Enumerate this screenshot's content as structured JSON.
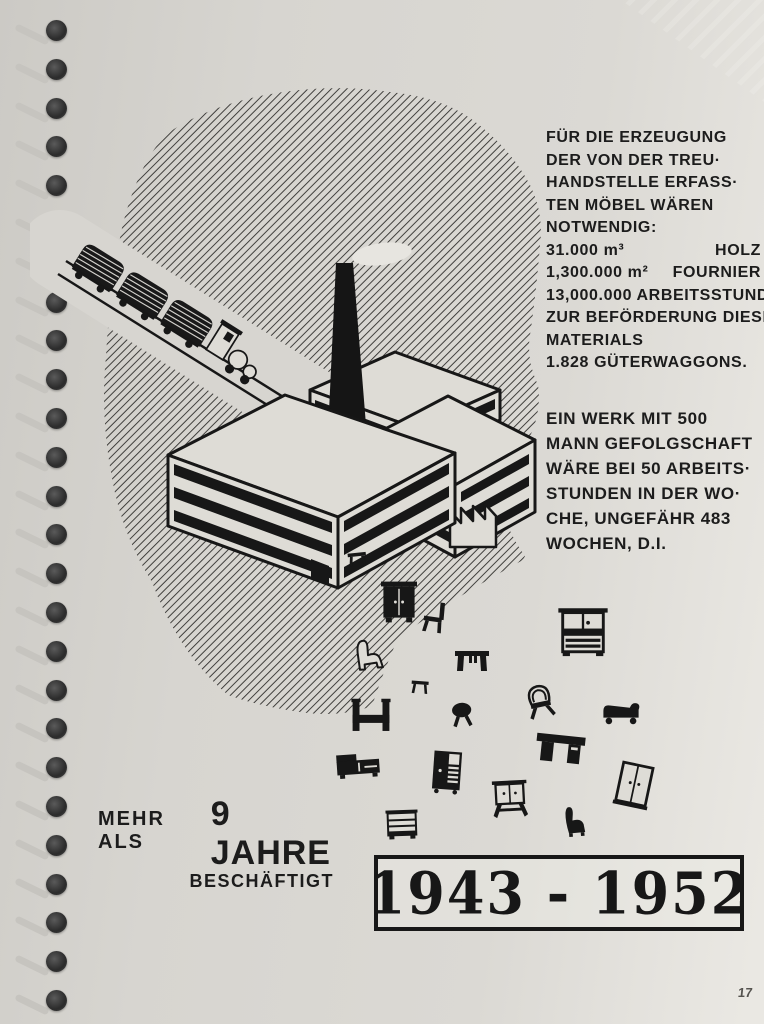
{
  "page": {
    "number": "17"
  },
  "materials_block": {
    "lines": [
      "FÜR DIE ERZEUGUNG",
      "DER VON DER TREU·",
      "HANDSTELLE ERFASS·",
      "TEN MÖBEL WÄREN",
      "NOTWENDIG:"
    ],
    "figures": [
      {
        "value": "31.000 m³",
        "label": "HOLZ"
      },
      {
        "value": "1,300.000 m²",
        "label": "FOURNIER"
      }
    ],
    "lines_after": [
      "13,000.000 ARBEITSSTUNDEN",
      "ZUR BEFÖRDERUNG DIESES",
      "MATERIALS",
      "1.828 GÜTERWAGGONS."
    ]
  },
  "work_block": {
    "lines": [
      "EIN WERK MIT 500",
      "MANN GEFOLGSCHAFT",
      "WÄRE BEI 50 ARBEITS·",
      "STUNDEN IN DER WO·",
      "CHE, UNGEFÄHR 483",
      "WOCHEN, D.I."
    ]
  },
  "caption": {
    "prefix": "MEHR ALS",
    "years": "9 JAHRE",
    "suffix": "BESCHÄFTIGT"
  },
  "year_box": {
    "range": "1943 - 1952"
  },
  "colors": {
    "paper": "#d9d7d2",
    "ink": "#171717",
    "hatch": "#2f2e2c"
  },
  "binding": {
    "holes": 26
  },
  "illustration": {
    "scene_parts": [
      "hatched-cloud-background",
      "rail-track",
      "freight-train-icon",
      "log-wagon-icon",
      "locomotive-icon",
      "smoke-puff-icon",
      "smokestack-icon",
      "factory-building-icon",
      "sawtooth-roof-icon"
    ],
    "furniture": [
      {
        "icon": "stool-icon",
        "type": "stool",
        "x": 357,
        "y": 557,
        "size": 28,
        "rot": -6
      },
      {
        "icon": "wardrobe-icon",
        "type": "wardrobe",
        "x": 399,
        "y": 602,
        "size": 48,
        "rot": 0
      },
      {
        "icon": "chair-icon",
        "type": "chair",
        "x": 434,
        "y": 617,
        "size": 36,
        "rot": 8
      },
      {
        "icon": "armchair-icon",
        "type": "armchair-outline",
        "x": 371,
        "y": 655,
        "size": 40,
        "rot": -4
      },
      {
        "icon": "table-icon",
        "type": "table",
        "x": 472,
        "y": 660,
        "size": 40,
        "rot": 0
      },
      {
        "icon": "stool-icon",
        "type": "stool",
        "x": 420,
        "y": 685,
        "size": 26,
        "rot": 4
      },
      {
        "icon": "dresser-icon",
        "type": "dresser",
        "x": 583,
        "y": 630,
        "size": 58,
        "rot": 0
      },
      {
        "icon": "wicker-chair-icon",
        "type": "wicker-chair",
        "x": 540,
        "y": 701,
        "size": 40,
        "rot": -12
      },
      {
        "icon": "bed-icon",
        "type": "bed",
        "x": 371,
        "y": 716,
        "size": 46,
        "rot": 0
      },
      {
        "icon": "round-stool-icon",
        "type": "round-stool",
        "x": 462,
        "y": 714,
        "size": 32,
        "rot": -5
      },
      {
        "icon": "chaise-icon",
        "type": "chaise",
        "x": 621,
        "y": 711,
        "size": 44,
        "rot": 0
      },
      {
        "icon": "sideboard-icon",
        "type": "sideboard",
        "x": 358,
        "y": 764,
        "size": 50,
        "rot": -4
      },
      {
        "icon": "cabinet-icon",
        "type": "cabinet",
        "x": 447,
        "y": 771,
        "size": 46,
        "rot": 4
      },
      {
        "icon": "desk-icon",
        "type": "desk",
        "x": 560,
        "y": 750,
        "size": 54,
        "rot": 6
      },
      {
        "icon": "washstand-icon",
        "type": "washstand",
        "x": 510,
        "y": 799,
        "size": 46,
        "rot": -3
      },
      {
        "icon": "wardrobe-icon",
        "type": "wardrobe-light",
        "x": 634,
        "y": 786,
        "size": 50,
        "rot": 12
      },
      {
        "icon": "armchair-icon",
        "type": "armchair-solid",
        "x": 577,
        "y": 821,
        "size": 36,
        "rot": -5
      },
      {
        "icon": "commode-icon",
        "type": "commode",
        "x": 402,
        "y": 826,
        "size": 40,
        "rot": -2
      }
    ]
  }
}
